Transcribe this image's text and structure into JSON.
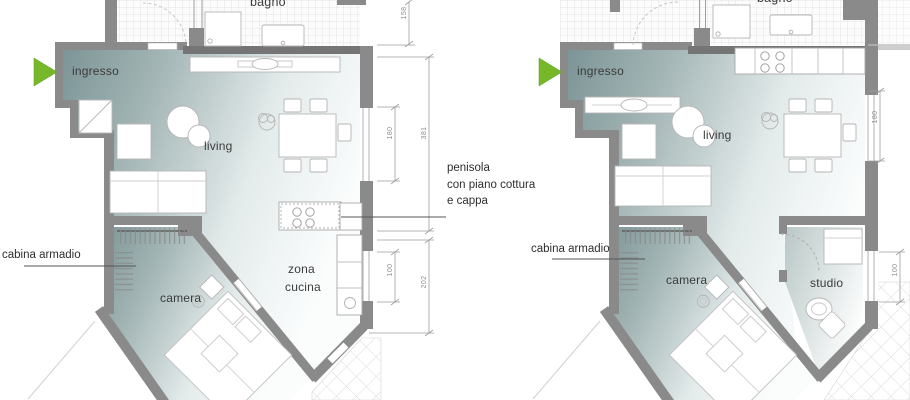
{
  "colors": {
    "floor_teal": "#7d9596",
    "wall_gray": "#8a8a8a",
    "accent_green": "#76b82a",
    "dimension_gray": "#8f8f8f",
    "label_text": "#3b3b3b"
  },
  "left_plan": {
    "labels": {
      "bagno": "bagno",
      "ingresso": "ingresso",
      "living": "living",
      "camera": "camera",
      "zona_cucina_line1": "zona",
      "zona_cucina_line2": "cucina"
    },
    "dimensions": {
      "bagno_height": "158",
      "living_total": "381",
      "living_window": "180",
      "kitchen_window": "100",
      "kitchen_total": "202"
    }
  },
  "right_plan": {
    "labels": {
      "bagno": "bagno",
      "ingresso": "ingresso",
      "living": "living",
      "camera": "camera",
      "studio": "studio"
    },
    "dimensions": {
      "living_window": "180",
      "studio_window": "100"
    }
  },
  "callouts": {
    "penisola_line1": "penisola",
    "penisola_line2": "con piano cottura",
    "penisola_line3": "e cappa",
    "cabina_armadio_left": "cabina armadio",
    "cabina_armadio_right": "cabina armadio"
  }
}
